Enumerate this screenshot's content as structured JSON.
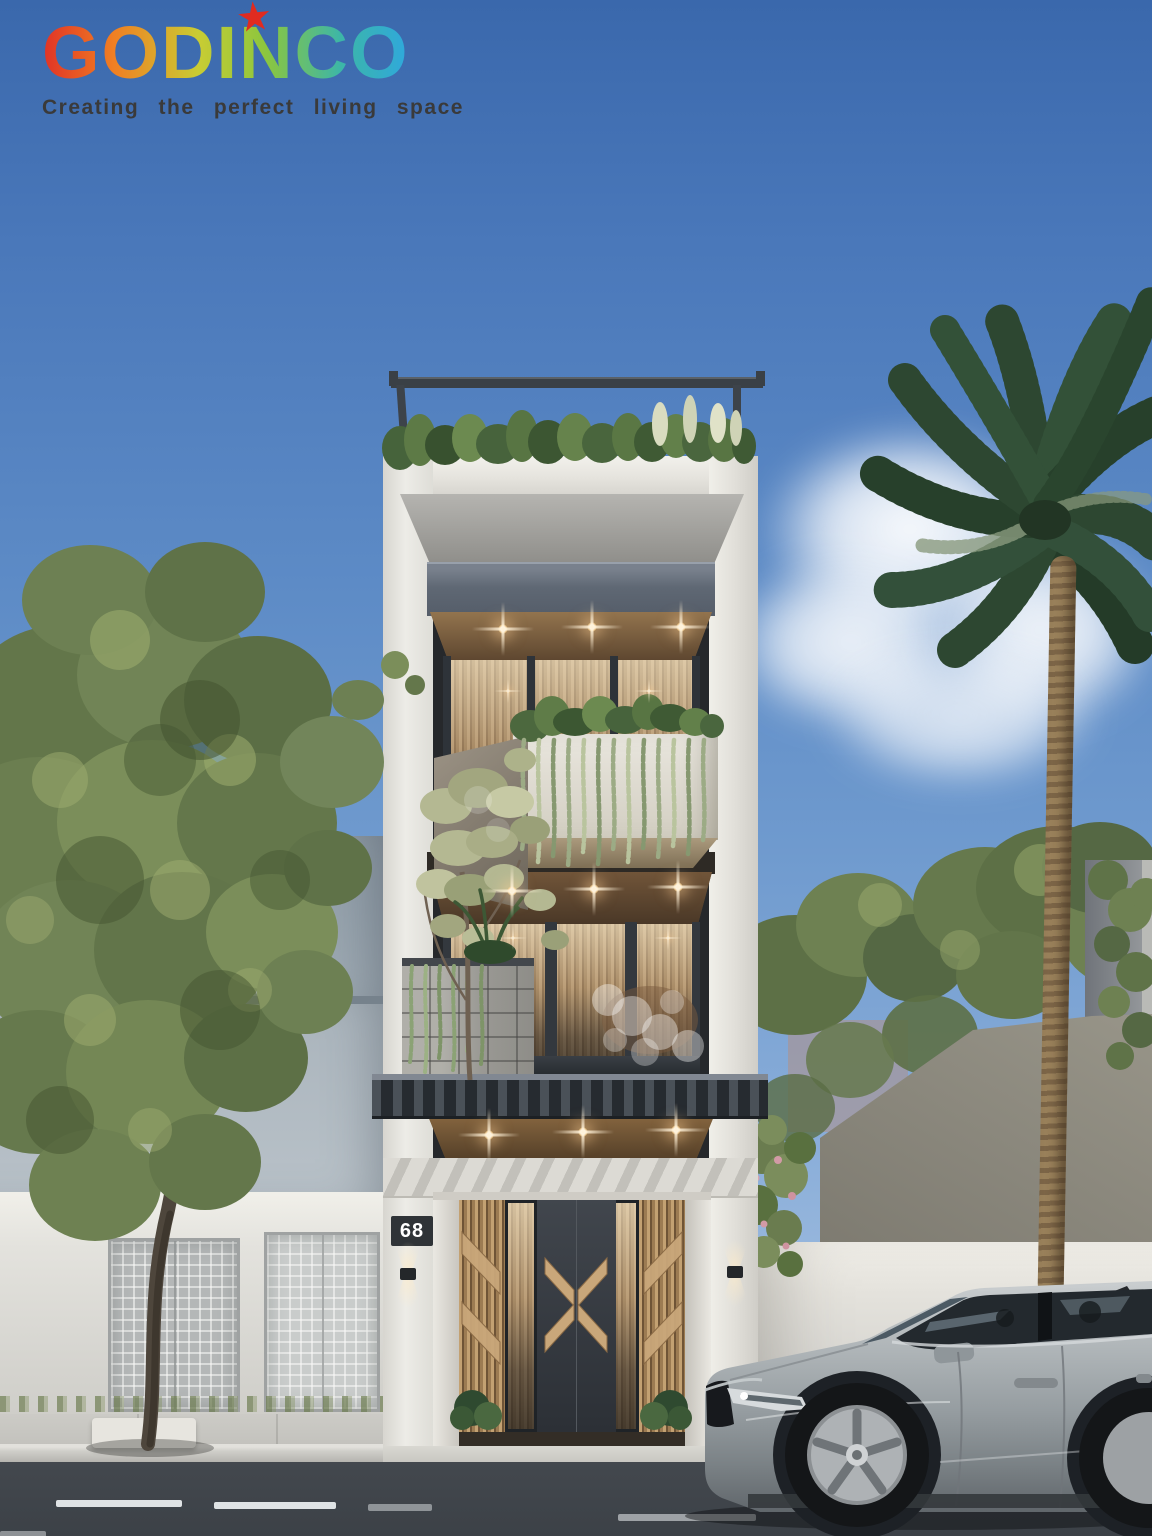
{
  "brand": {
    "name": "GODINCO",
    "star": "★",
    "tagline": "Creating the perfect living space"
  },
  "building": {
    "house_number": "68",
    "floors_visible": 4,
    "features": [
      "rooftop garden with metal railing",
      "white concrete planter with hanging vines",
      "stone-clad planter",
      "wood slat entrance gate with chevron motifs",
      "recessed downlights"
    ]
  },
  "scene": {
    "vehicle": "gray SUV parked at curb",
    "vegetation": [
      "large leafy tree left",
      "palm tree right",
      "rooftop plants",
      "creeper vines on walls"
    ],
    "setting": "street-front modern townhouse, daytime clear sky"
  },
  "palette": {
    "sky_top": "#3a68ac",
    "sky_mid": "#5d8bc6",
    "sky_low": "#9dbbde",
    "facade": "#e9e7e2",
    "pier_shade": "#d6d4ce",
    "dark_metal": "#3a4046",
    "fascia": "#5f6874",
    "concrete": "#a7a6a2",
    "wood_dark": "#5e4730",
    "wood": "#8a6a45",
    "wood_light": "#c9a77a",
    "curtain": "#b2926c",
    "planter": "#e7e4dc",
    "stone": "#a1a09b",
    "glow": "#ffdfae",
    "foliage": "#6f8350",
    "foliage_dark": "#47583a",
    "palm": "#2e4a31",
    "trunk": "#8d744f",
    "neighbor": "#a3aeb8",
    "white_wall": "#e3e1db",
    "gate": "#c2c5c5",
    "sidewalk": "#c6c5c0",
    "curb": "#d8d7d2",
    "road": "#43484e",
    "lane": "#dfe3e5",
    "car": "#9aa1a6",
    "car_dark": "#2a2f34",
    "logo_red": "#e03226",
    "logo_orange": "#f07f23",
    "logo_yellow": "#c9cc33",
    "logo_green": "#8cc63e",
    "logo_teal": "#3cb6a8",
    "logo_blue": "#2fa8dd",
    "tagline": "#3a3a3a",
    "star": "#e02b20",
    "plaque": "#2f3337",
    "number": "#ffffff"
  }
}
